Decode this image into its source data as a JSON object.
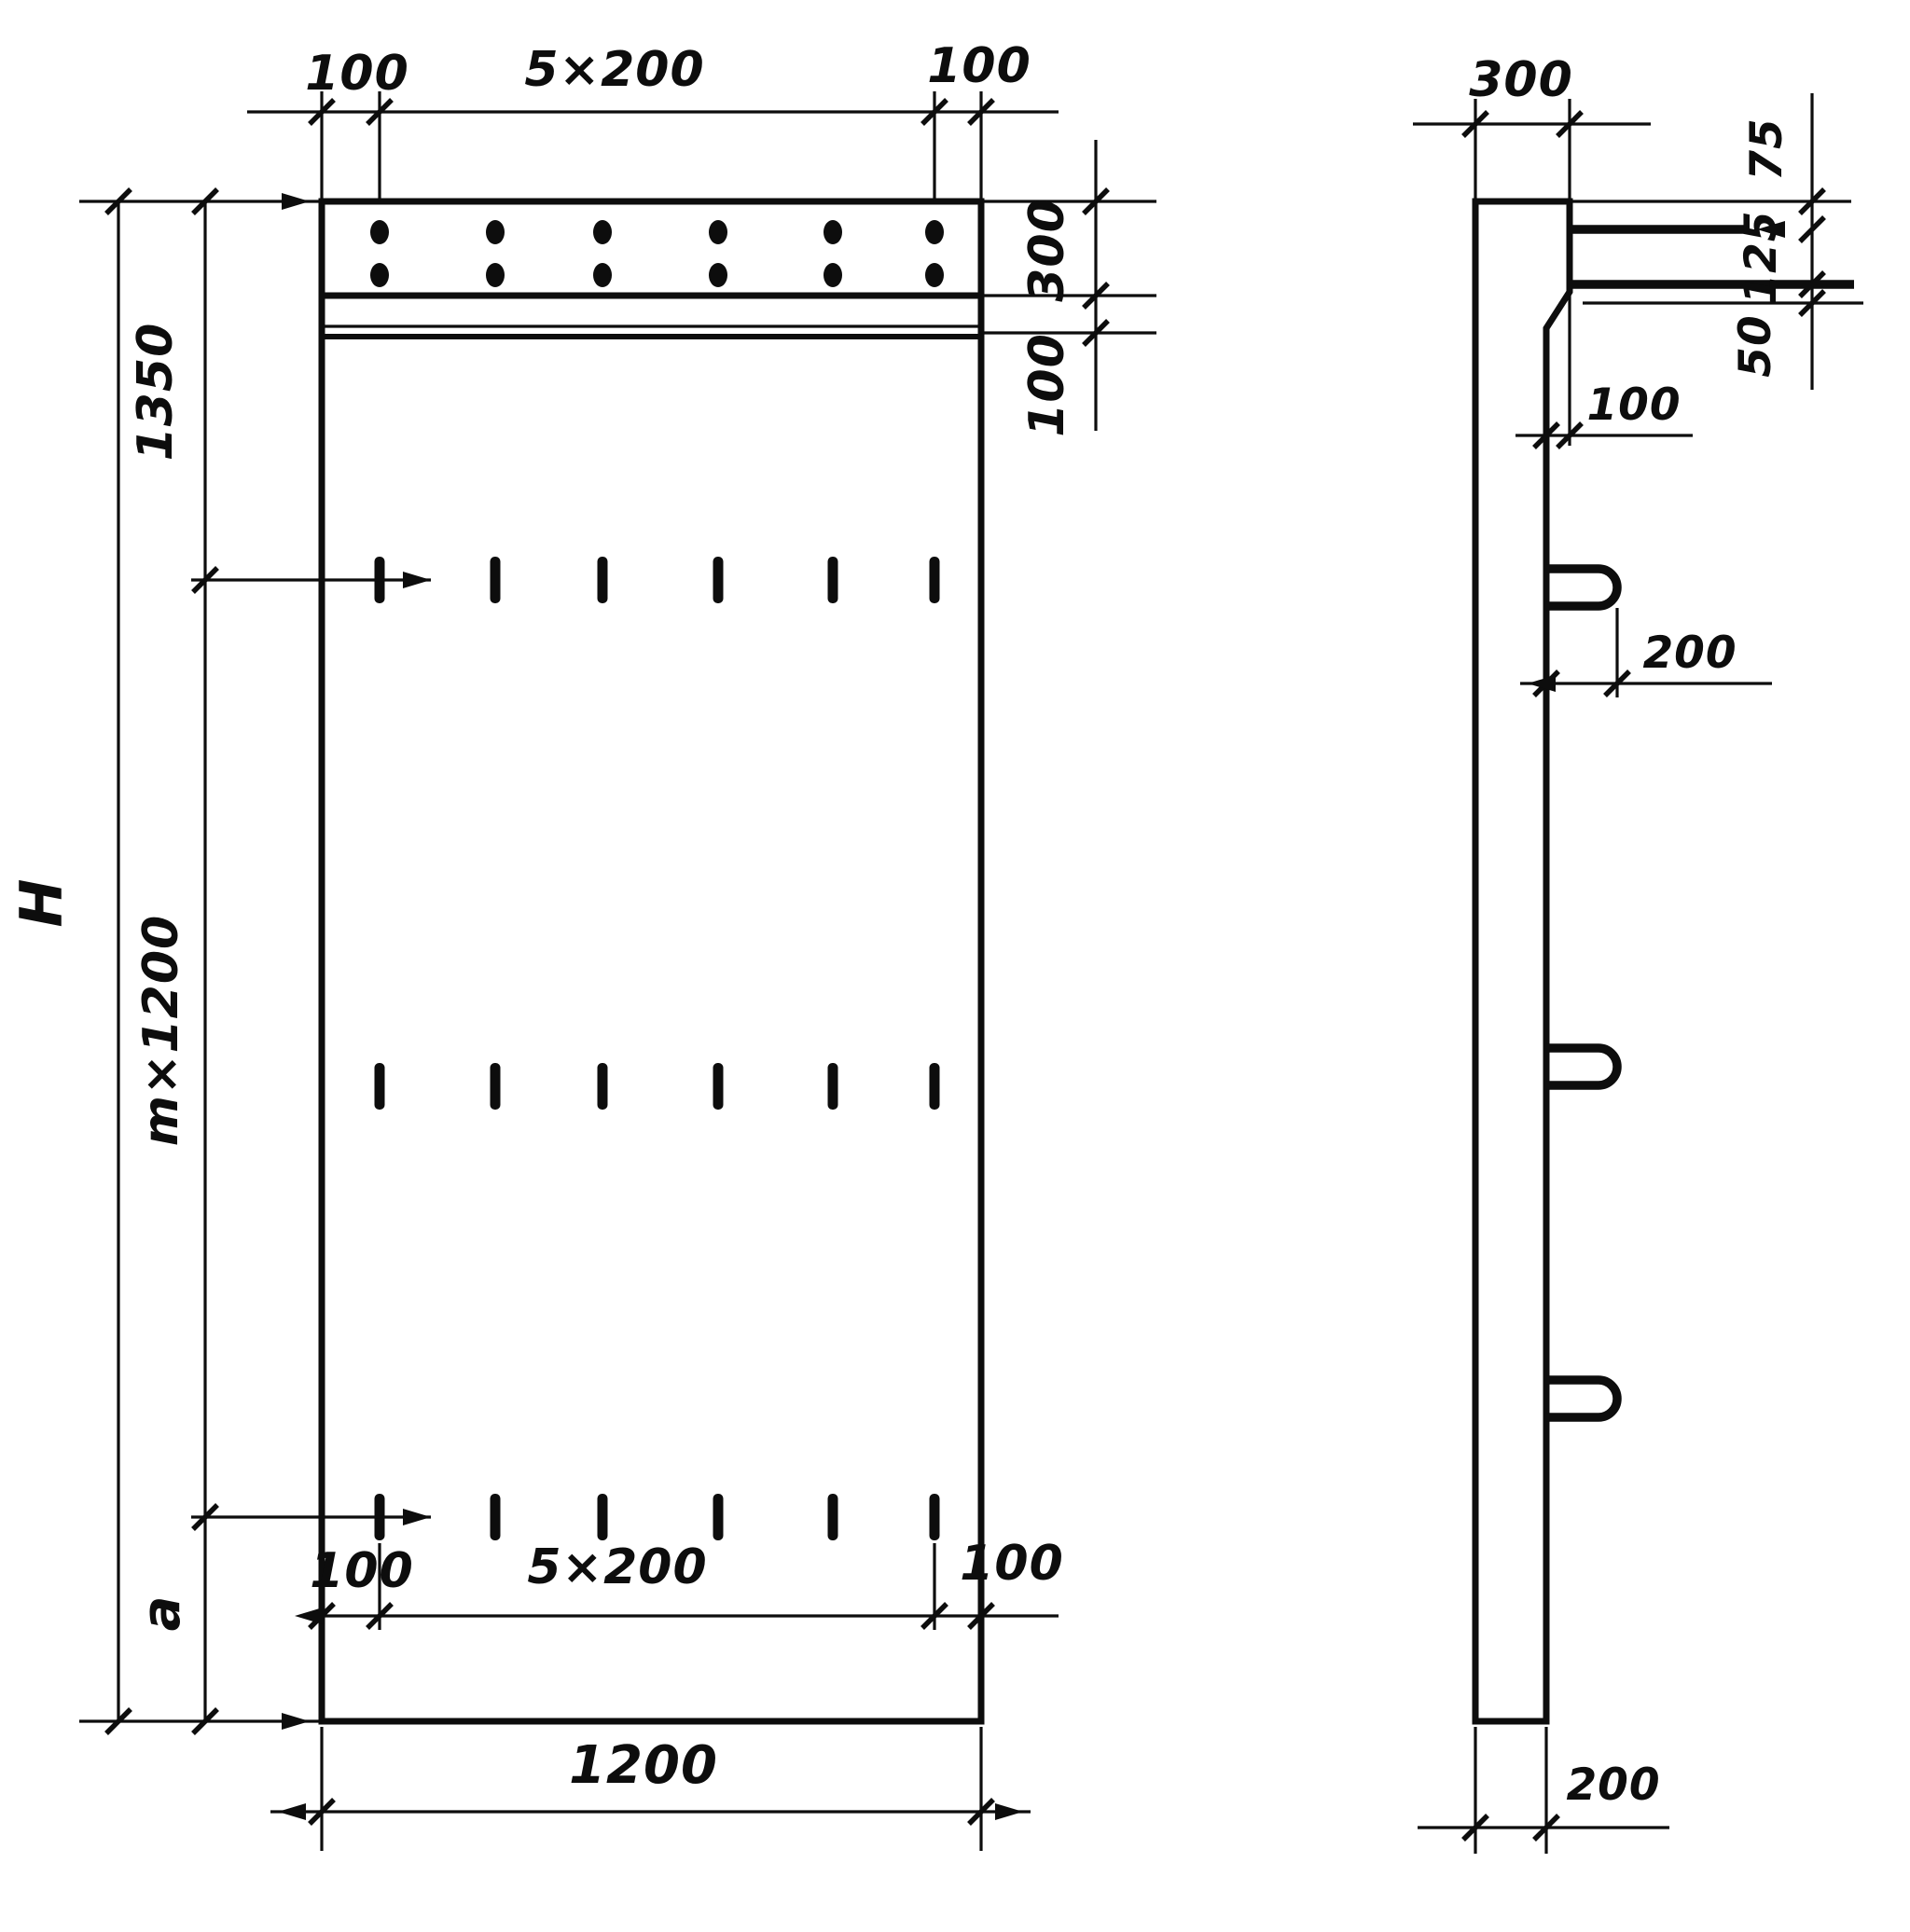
{
  "drawing": {
    "front_view": {
      "top_dim": {
        "left_margin": "100",
        "spacing": "5×200",
        "right_margin": "100"
      },
      "right_dim": {
        "band_height": "300",
        "strip_gap": "100"
      },
      "left_dim": {
        "upper_zone": "1350",
        "total_height": "H",
        "module_zone": "m×1200",
        "lower_zone": "a"
      },
      "bottom_dim": {
        "left_margin": "100",
        "spacing": "5×200",
        "right_margin": "100",
        "overall_width": "1200"
      }
    },
    "side_view": {
      "head_depth": "300",
      "dowel_dims": {
        "top_offset": "75",
        "spacing": "125",
        "bottom_offset": "50"
      },
      "step_offset": "100",
      "loop_protrusion": "200",
      "panel_thickness": "200"
    }
  }
}
